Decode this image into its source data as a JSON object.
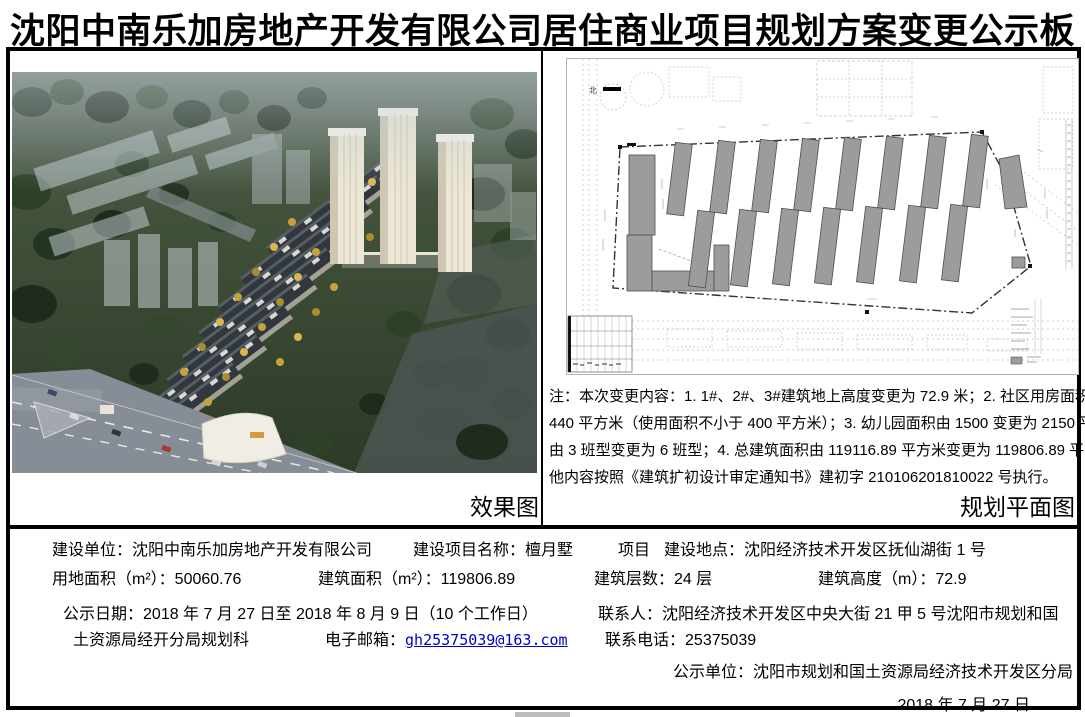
{
  "title": "沈阳中南乐加房地产开发有限公司居住商业项目规划方案变更公示板",
  "colors": {
    "border": "#000000",
    "divider": "#000000",
    "email": "#0000cc",
    "building": "#9c9c9c",
    "artifact": "#bcbcbc"
  },
  "left_panel": {
    "caption": "效果图"
  },
  "right_panel": {
    "caption": "规划平面图",
    "north_label": "北",
    "note_lines": [
      "注：本次变更内容：1. 1#、2#、3#建筑地上高度变更为 72.9 米；2. 社区用房面积变更为",
      "440 平方米（使用面积不小于 400 平方米）；3. 幼儿园面积由 1500 变更为 2150 平方米，",
      "由 3 班型变更为 6 班型；4. 总建筑面积由 119116.89 平方米变更为 119806.89 平方米。其",
      "他内容按照《建筑扩初设计审定通知书》建初字 210106201810022 号执行。"
    ]
  },
  "details": {
    "row1": {
      "l1": "建设单位：",
      "v1": "沈阳中南乐加房地产开发有限公司",
      "l2": "建设项目名称：",
      "v2": "檀月墅",
      "v2b": "项目",
      "l3": "建设地点：",
      "v3": "沈阳经济技术开发区抚仙湖街 1 号"
    },
    "row2": {
      "l1": "用地面积（m²）：",
      "v1": "50060.76",
      "l2": "建筑面积（m²）：",
      "v2": "119806.89",
      "l3": "建筑层数：",
      "v3": "24 层",
      "l4": "建筑高度（m）：",
      "v4": "72.9"
    },
    "row3": {
      "l1": "公示日期：",
      "v1": "2018 年 7 月 27 日至 2018 年 8 月 9 日（10 个工作日）",
      "l2": "联系人：",
      "v2": "沈阳经济技术开发区中央大街 21 甲 5 号沈阳市规划和国"
    },
    "row4": {
      "v1": "土资源局经开分局规划科",
      "l2": "电子邮箱：",
      "v2": "gh25375039@163.com",
      "l3": "联系电话：",
      "v3": "25375039"
    },
    "row5": {
      "l1": "公示单位：",
      "v1": "沈阳市规划和国土资源局经济技术开发区分局"
    },
    "row6": {
      "v1": "2018 年 7 月 27 日"
    }
  }
}
